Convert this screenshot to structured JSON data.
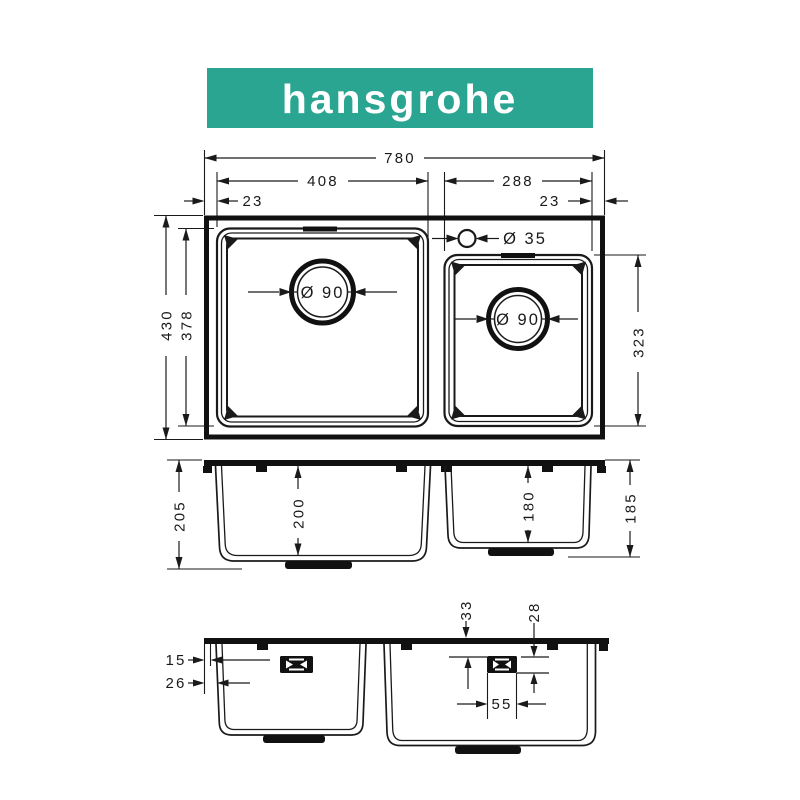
{
  "brand": {
    "logo_text": "hansgrohe"
  },
  "colors": {
    "logo_bg": "#2aa592",
    "logo_fg": "#ffffff",
    "line": "#1a1a1a"
  },
  "top_view": {
    "dim_total_width": "780",
    "dim_left_bowl_width": "408",
    "dim_right_bowl_width": "288",
    "dim_left_edge": "23",
    "dim_right_edge": "23",
    "dim_total_depth": "430",
    "dim_inner_depth": "378",
    "dim_right_bowl_depth": "323",
    "label_left_drain": "Ø 90",
    "label_right_drain": "Ø 90",
    "label_tap_hole": "Ø 35"
  },
  "front_section": {
    "dim_outer_depth_left": "205",
    "dim_left_bowl_depth": "200",
    "dim_right_bowl_depth": "180",
    "dim_outer_depth_right": "185"
  },
  "side_section": {
    "dim_top_offset": "33",
    "dim_clip_drop": "28",
    "dim_lip_upper": "15",
    "dim_lip_lower": "26",
    "dim_clip_width": "55"
  }
}
